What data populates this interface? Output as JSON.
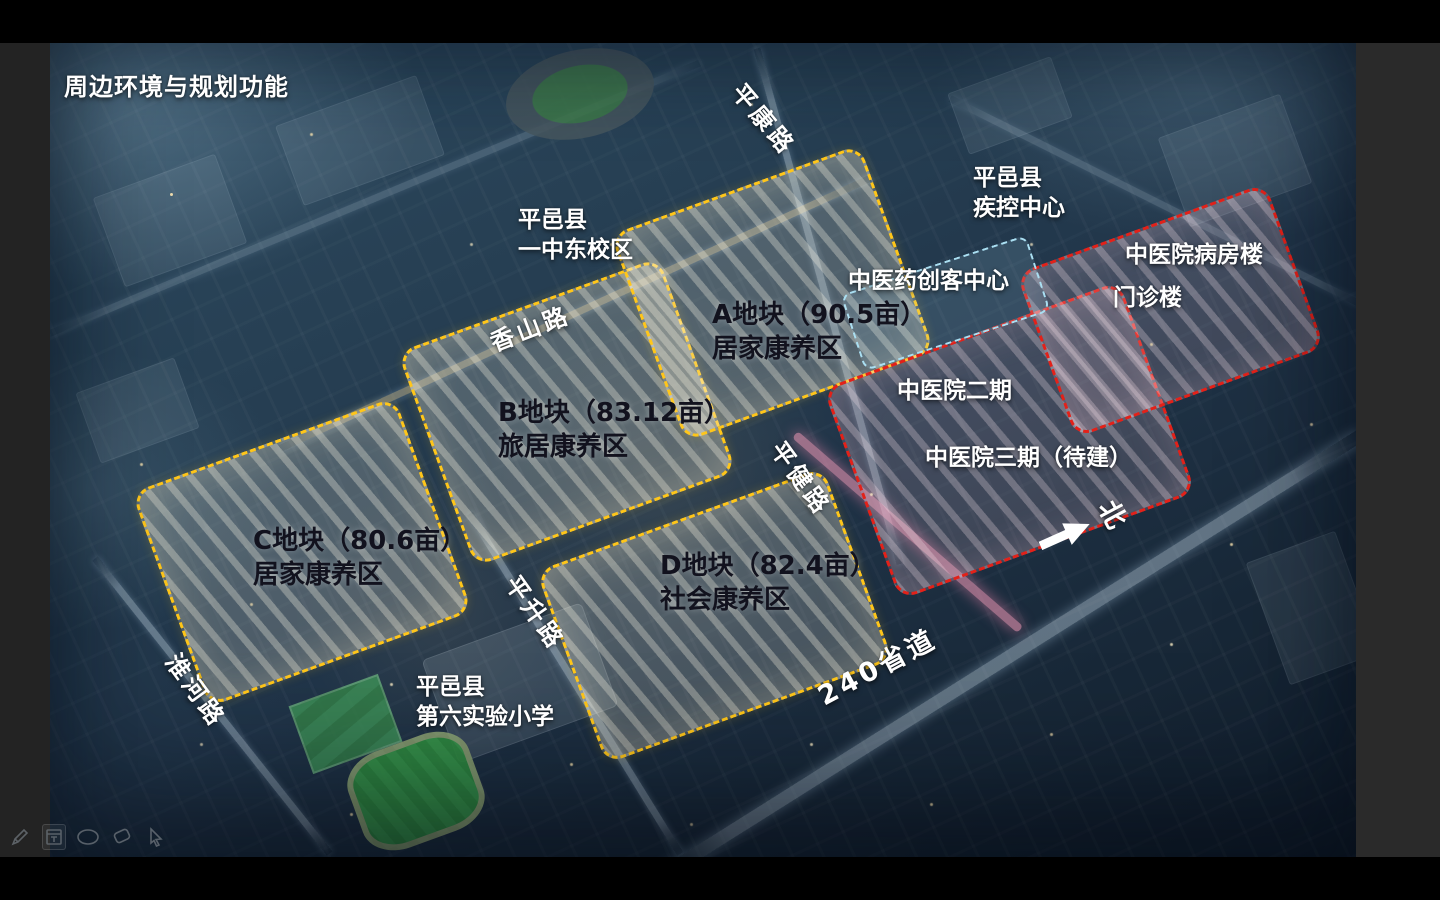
{
  "slide": {
    "title": "周边环境与规划功能",
    "landmarks": {
      "school_east": {
        "line1": "平邑县",
        "line2": "一中东校区"
      },
      "cdc": {
        "line1": "平邑县",
        "line2": "疾控中心"
      },
      "ward_building": "中医院病房楼",
      "outpatient_building": "门诊楼",
      "maker_center": "中医药创客中心",
      "hospital_phase2": "中医院二期",
      "hospital_phase3": "中医院三期（待建）",
      "primary_school": {
        "line1": "平邑县",
        "line2": "第六实验小学"
      },
      "north_marker": "北"
    },
    "plots": {
      "a": {
        "line1": "A地块（90.5亩）",
        "line2": "居家康养区"
      },
      "b": {
        "line1": "B地块（83.12亩）",
        "line2": "旅居康养区"
      },
      "c": {
        "line1": "C地块（80.6亩）",
        "line2": "居家康养区"
      },
      "d": {
        "line1": "D地块（82.4亩）",
        "line2": "社会康养区"
      }
    },
    "roads": {
      "pingkang": "平康路",
      "xiangshan": "香山路",
      "pingjian": "平健路",
      "pingsheng": "平升路",
      "huaihe": "淮河路",
      "s240": "240省道"
    },
    "colors": {
      "plot_boundary": "#ffc61a",
      "hospital_boundary": "#e32119",
      "maker_boundary": "#aadff2",
      "pink_road_glow": "#ff9ebe"
    }
  },
  "toolbar": {
    "tools": [
      "pen",
      "panel",
      "ellipse",
      "eraser",
      "cursor"
    ]
  }
}
